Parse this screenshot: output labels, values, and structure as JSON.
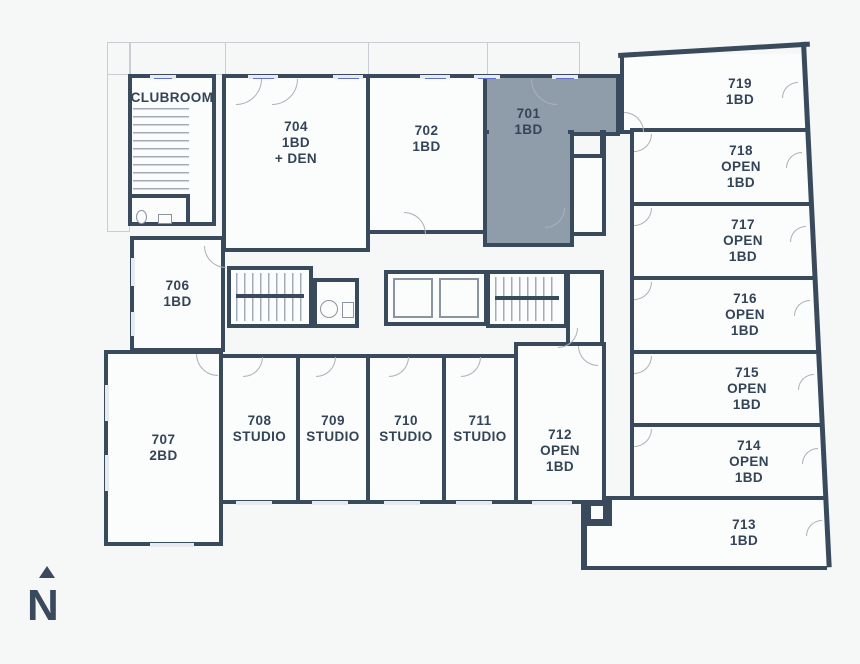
{
  "colors": {
    "wall": "#3a4a5d",
    "highlight": "#8f9dab",
    "background": "#f6f7f7",
    "room_fill": "#fbfcfc"
  },
  "compass": {
    "label": "N"
  },
  "amenities": {
    "clubroom": {
      "name": "CLUBROOM"
    }
  },
  "units": {
    "u701": {
      "number": "701",
      "type": "1BD",
      "highlighted": true
    },
    "u702": {
      "number": "702",
      "type": "1BD"
    },
    "u704": {
      "number": "704",
      "type": "1BD\n+ DEN"
    },
    "u706": {
      "number": "706",
      "type": "1BD"
    },
    "u707": {
      "number": "707",
      "type": "2BD"
    },
    "u708": {
      "number": "708",
      "type": "STUDIO"
    },
    "u709": {
      "number": "709",
      "type": "STUDIO"
    },
    "u710": {
      "number": "710",
      "type": "STUDIO"
    },
    "u711": {
      "number": "711",
      "type": "STUDIO"
    },
    "u712": {
      "number": "712",
      "type": "OPEN\n1BD"
    },
    "u713": {
      "number": "713",
      "type": "1BD"
    },
    "u714": {
      "number": "714",
      "type": "OPEN\n1BD"
    },
    "u715": {
      "number": "715",
      "type": "OPEN\n1BD"
    },
    "u716": {
      "number": "716",
      "type": "OPEN\n1BD"
    },
    "u717": {
      "number": "717",
      "type": "OPEN\n1BD"
    },
    "u718": {
      "number": "718",
      "type": "OPEN\n1BD"
    },
    "u719": {
      "number": "719",
      "type": "1BD"
    }
  }
}
